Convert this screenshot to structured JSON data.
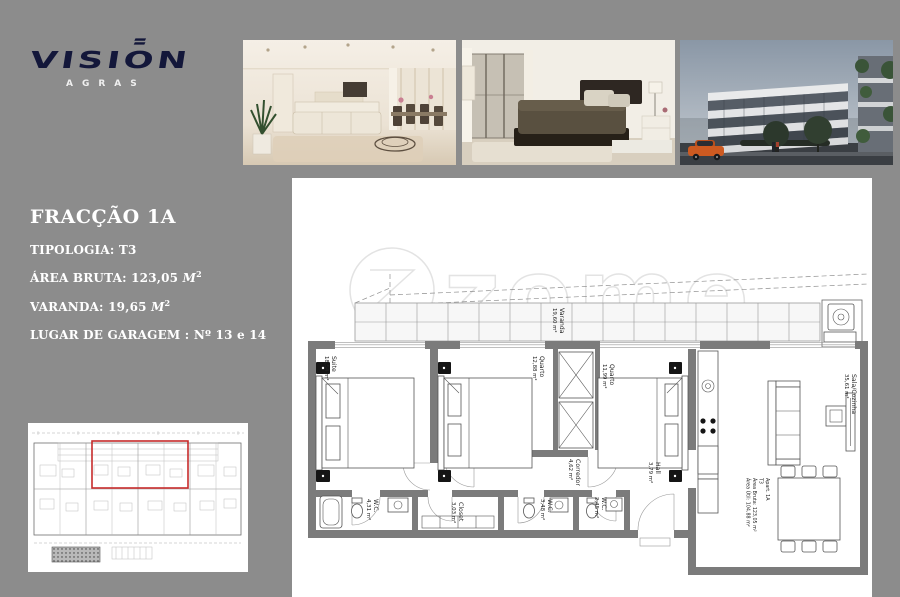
{
  "page": {
    "background": "#8c8c8c",
    "panel": "#ffffff"
  },
  "logo": {
    "brand": "VISION",
    "subtitle": "AGRAS",
    "brand_color": "#13173a"
  },
  "photos": {
    "items": [
      {
        "name": "living-room-render"
      },
      {
        "name": "bedroom-render"
      },
      {
        "name": "building-exterior-render"
      }
    ]
  },
  "sidebar": {
    "title": "FRACÇÃO 1A",
    "items": [
      {
        "label": "TIPOLOGIA:",
        "value": "T3",
        "unit": "",
        "sup": ""
      },
      {
        "label": "ÁREA BRUTA:",
        "value": "123,05",
        "unit": "M",
        "sup": "2"
      },
      {
        "label": "VARANDA:",
        "value": "19,65",
        "unit": "M",
        "sup": "2"
      },
      {
        "label": "LUGAR DE GARAGEM :",
        "value": "Nº 13 e 14",
        "unit": "",
        "sup": ""
      }
    ]
  },
  "floor_plan": {
    "watermark": "zome",
    "highlight_color": "#c62b2b",
    "rooms": {
      "varanda": {
        "name": "Varanda",
        "area": "19,60 m²"
      },
      "suite": {
        "name": "Suite",
        "area": "18,54 m²"
      },
      "quarto1": {
        "name": "Quarto",
        "area": "12,88 m²"
      },
      "quarto2": {
        "name": "Quarto",
        "area": "11,99 m²"
      },
      "corredor": {
        "name": "Corredor",
        "area": "4,62 m²"
      },
      "hall": {
        "name": "Hall",
        "area": "3,79 m²"
      },
      "sala": {
        "name": "Sala/Cozinha",
        "area": "35,61 m²"
      },
      "wc1": {
        "name": "W.C.",
        "area": "4,31 m²"
      },
      "closet": {
        "name": "Closet",
        "area": "3,03 m²"
      },
      "wc2": {
        "name": "W.C.",
        "area": "3,48 m²"
      },
      "wc3": {
        "name": "W.C.",
        "area": "2,45 m²"
      }
    },
    "info": [
      "Apart. 1A",
      "T3",
      "Área Bruta: 123,05 m²",
      "Área Útil: 104,88 m²"
    ]
  }
}
